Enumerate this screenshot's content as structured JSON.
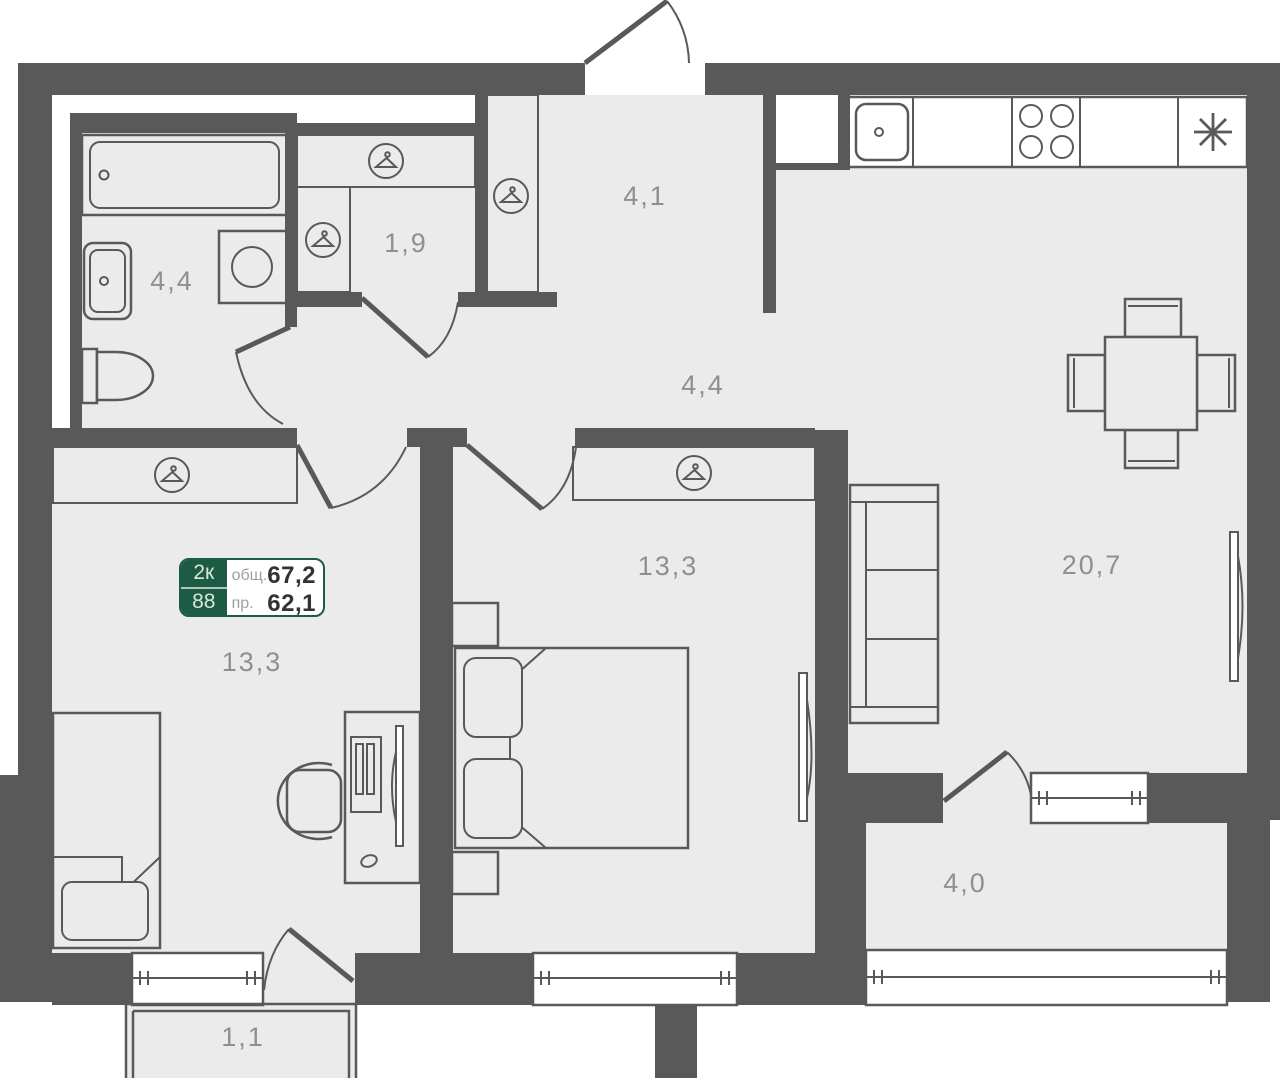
{
  "plan": {
    "badge": {
      "room_count": "2к",
      "unit_number": "88",
      "total_area_label": "общ.",
      "total_area_value": "67,2",
      "living_area_label": "пр.",
      "living_area_value": "62,1"
    },
    "rooms": {
      "bathroom": {
        "area": "4,4"
      },
      "closet": {
        "area": "1,9"
      },
      "entry": {
        "area": "4,1"
      },
      "hall": {
        "area": "4,4"
      },
      "room_left": {
        "area": "13,3"
      },
      "bedroom": {
        "area": "13,3"
      },
      "kitchen_living": {
        "area": "20,7"
      },
      "loggia": {
        "area": "4,0"
      },
      "balcony": {
        "area": "1,1"
      }
    },
    "icons": [
      "hanger-icon",
      "snowflake-icon"
    ],
    "colors": {
      "wall": "#595959",
      "floor": "#ebebeb",
      "accent_green": "#1d5b45",
      "label_gray": "#8f8f8f"
    }
  }
}
